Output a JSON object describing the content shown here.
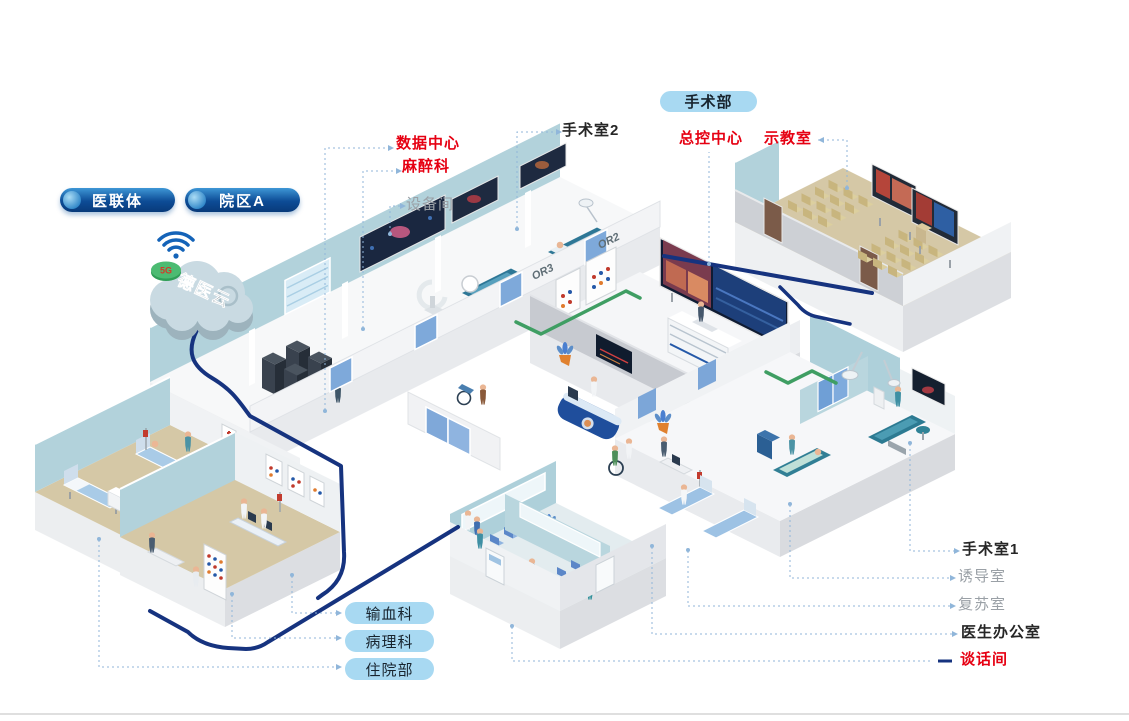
{
  "cloud": {
    "name": "德医云",
    "badge": "5G"
  },
  "network": {
    "pills": [
      {
        "label": "医联体"
      },
      {
        "label": "院区A"
      }
    ]
  },
  "surgery_header": {
    "label": "手术部"
  },
  "callouts": {
    "data_center": "数据中心",
    "anesthesia": "麻醉科",
    "equipment_room": "设备间",
    "operating_room_2": "手术室2",
    "master_control": "总控中心",
    "demo_classroom": "示教室",
    "operating_room_1": "手术室1",
    "induction_room": "诱导室",
    "recovery_room": "复苏室",
    "doctor_office": "医生办公室",
    "talk_room": "谈话间"
  },
  "department_tags": [
    {
      "label": "输血科"
    },
    {
      "label": "病理科"
    },
    {
      "label": "住院部"
    }
  ],
  "room_wall_tags": {
    "or3": "OR3",
    "or2": "OR2"
  },
  "colors": {
    "label_red": "#e60012",
    "label_dark": "#262626",
    "label_muted": "#9aa0a6",
    "pill_dark_blue": "#0d4c96",
    "pill_light_blue": "#a8d9f2",
    "cable_navy": "#16337f",
    "cable_green": "#3f9e63",
    "wall_teal": "#b2d2db",
    "floor_tan": "#d5c8a6",
    "leader_blue": "#90b6da"
  }
}
